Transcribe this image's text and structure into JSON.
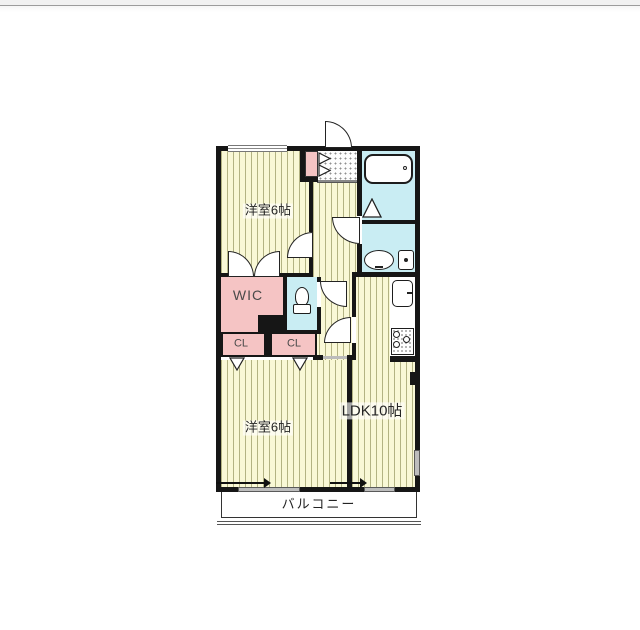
{
  "colors": {
    "floor": "#f9f8d6",
    "stripe": "#b3b383",
    "pink": "#f5c4c4",
    "cyan": "#c9edf3",
    "wall": "#161616",
    "window": "#bdbdbd",
    "topbar": "#f1f1f1",
    "topline": "#9c9c9c"
  },
  "labels": {
    "bedroom_top": "洋室6帖",
    "bedroom_bottom": "洋室6帖",
    "ldk": "LDK10帖",
    "wic": "WIC",
    "closet_left": "CL",
    "closet_right": "CL",
    "balcony": "バルコニー"
  }
}
